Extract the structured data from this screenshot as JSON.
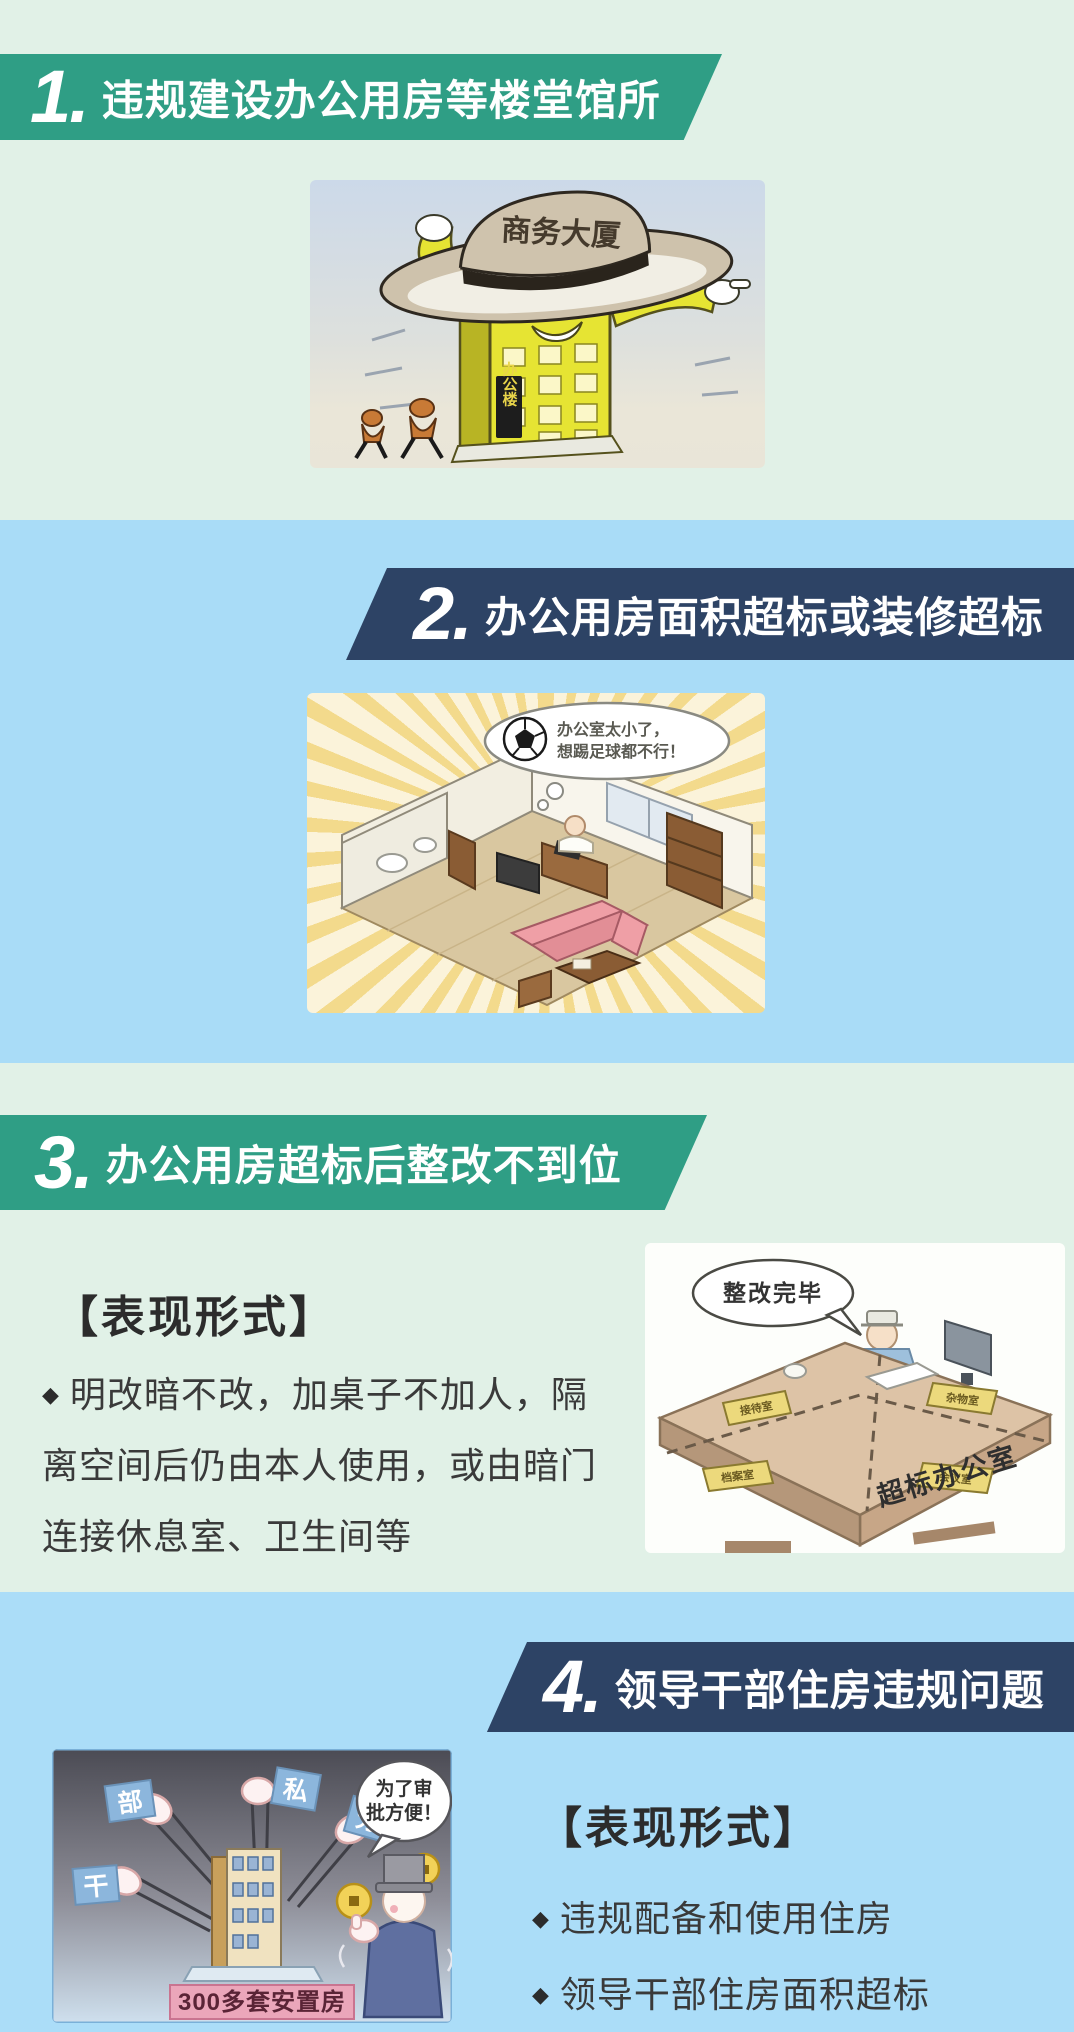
{
  "poster": {
    "bg_green": "#e1f1e7",
    "bg_blue": "#a9dcf7",
    "banner_green": "#2f9e85",
    "banner_navy": "#2d4365"
  },
  "section1": {
    "number": "1.",
    "title": "违规建设办公用房等楼堂馆所",
    "illustration": {
      "hat_text": "商务大厦",
      "building_sign": "办公楼"
    }
  },
  "section2": {
    "number": "2.",
    "title": "办公用房面积超标或装修超标",
    "illustration": {
      "thought_line1": "办公室太小了，",
      "thought_line2": "想踢足球都不行！"
    }
  },
  "section3": {
    "number": "3.",
    "title": "办公用房超标后整改不到位",
    "subheading": "【表现形式】",
    "bullet_marker": "◆",
    "bullet_text": "明改暗不改，加桌子不加人，隔离空间后仍由本人使用，或由暗门连接休息室、卫生间等",
    "illustration": {
      "speech": "整改完毕",
      "desk_label": "超标办公室",
      "placard_1": "接待室",
      "placard_2": "杂物室",
      "placard_3": "档案室",
      "placard_4": "会议室"
    }
  },
  "section4": {
    "number": "4.",
    "title": "领导干部住房违规问题",
    "subheading": "【表现形式】",
    "bullet_marker": "◆",
    "bullets": [
      "违规配备和使用住房",
      "领导干部住房面积超标"
    ],
    "illustration": {
      "speech_line1": "为了审",
      "speech_line2": "批方便！",
      "flag_1": "部",
      "flag_2": "私",
      "flag_3": "分",
      "flag_4": "干",
      "base_label": "300多套安置房"
    }
  }
}
